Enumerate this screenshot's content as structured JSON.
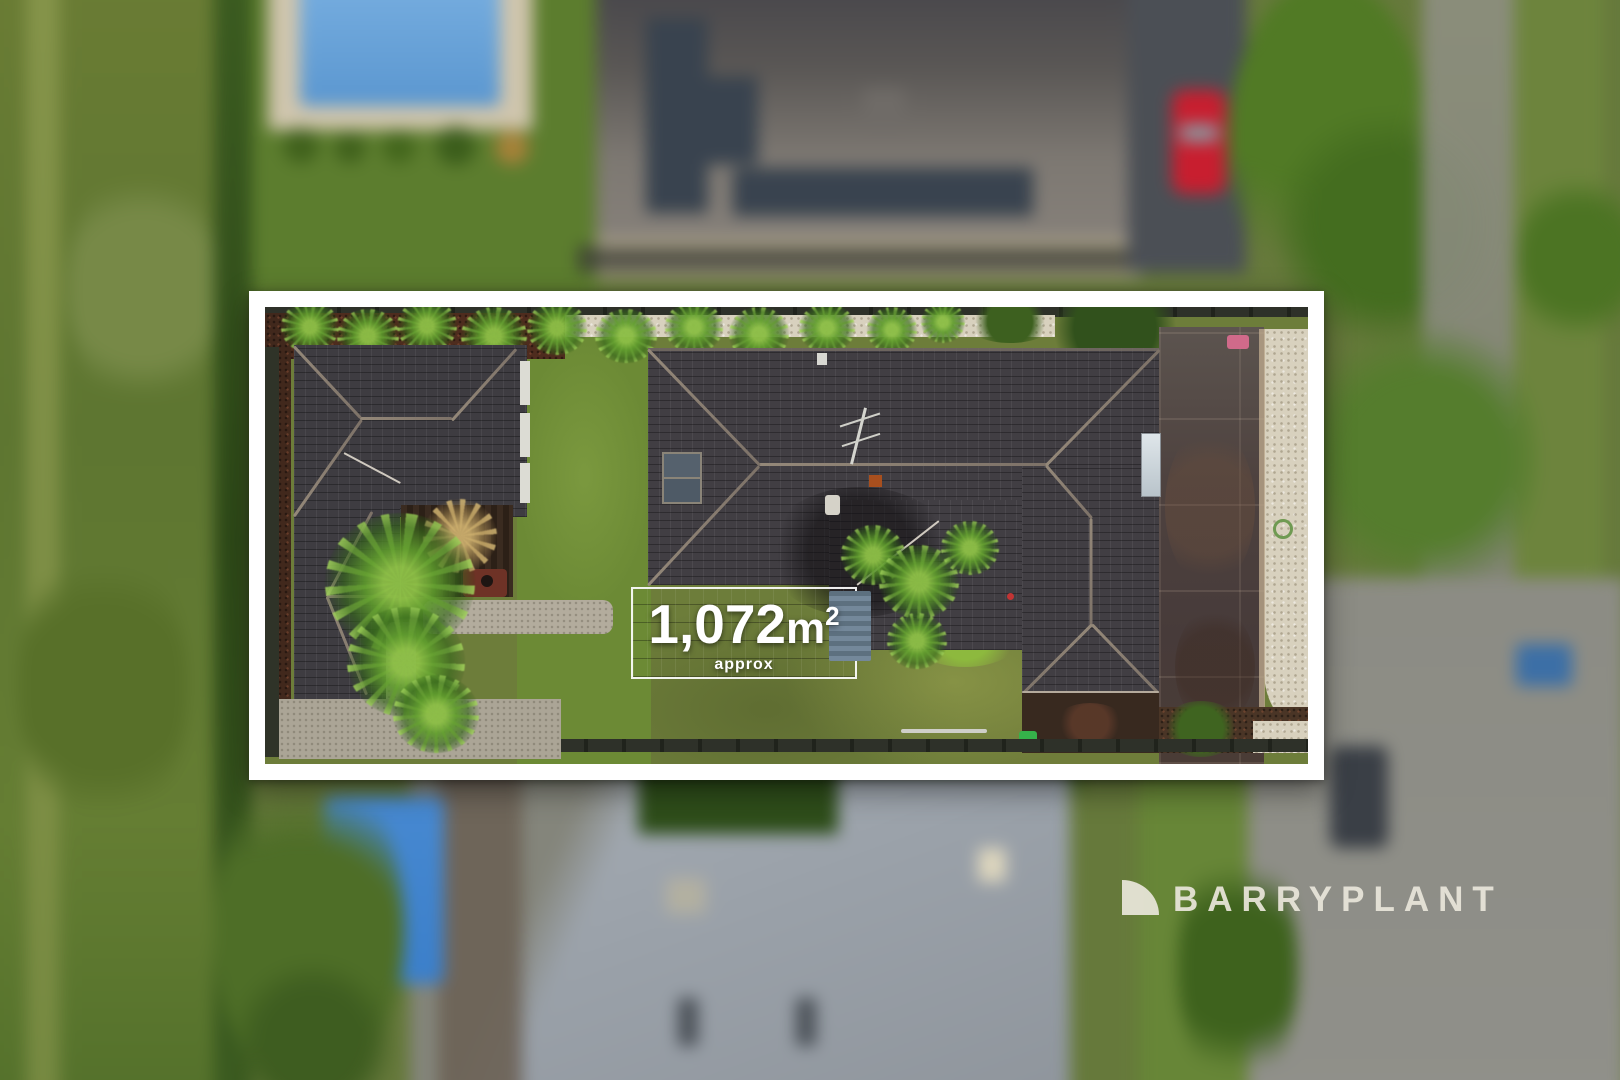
{
  "overlay": {
    "land_area": {
      "value": "1,072",
      "unit": "m",
      "unit_superscript": "2",
      "qualifier": "approx",
      "full_text": "1,072m² approx",
      "text_color": "#ffffff"
    },
    "boundary_frame": {
      "border_color": "#ffffff",
      "style": "solid-rectangle"
    },
    "watermark": {
      "brand": "BARRYPLANT",
      "icon": "quarter-circle-sail",
      "color": "#e9e6da"
    }
  },
  "scene": {
    "type": "aerial-drone-photo",
    "subject": "residential lot highlighted by white boundary frame, surroundings blurred",
    "inside_boundary_features": [
      "secondary-dwelling-roof",
      "pergola-courtyard",
      "palm-trees",
      "main-house-roof",
      "shed-roof-with-area-label",
      "central-lawn",
      "rear-lawn",
      "paved-driveway",
      "white-gravel-border",
      "mulch-garden-beds",
      "green-wheelie-bin"
    ],
    "outside_boundary_features": [
      "neighbour-pool-top-left",
      "neighbour-roof-with-solar-panels",
      "red-car-on-driveway",
      "street-right-side",
      "neighbour-house-below",
      "pool-bottom-left",
      "dark-parked-car-bottom-right",
      "blue-bin-right",
      "green-field-left"
    ],
    "palette": {
      "lawn": "#6d7d3a",
      "bright_lawn": "#6c8f35",
      "roof_dark": "#413e43",
      "ridge_light": "#8d8278",
      "driveway_pavers": "#4c3f3d",
      "gravel": "#d8d1be",
      "mulch": "#4e2c1e",
      "hedge": "#35521c",
      "palm": "#64a02c",
      "pool_top": "#70a7d7",
      "pool_bottom": "#3e7fc6",
      "red_car": "#c22030",
      "road": "#8c8c84",
      "neighbour_roof_below": "#9aa1a9",
      "solar_panel": "#39434e"
    }
  }
}
